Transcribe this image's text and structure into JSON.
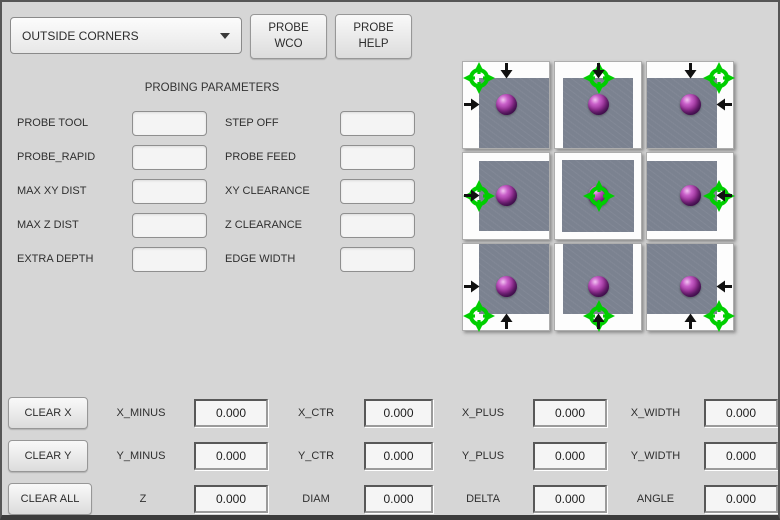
{
  "window": {
    "background": "#d6d6d6",
    "border_color": "#565656"
  },
  "toolbar": {
    "mode_select": {
      "value": "OUTSIDE CORNERS"
    },
    "probe_wco": {
      "line1": "PROBE",
      "line2": "WCO"
    },
    "probe_help": {
      "line1": "PROBE",
      "line2": "HELP"
    }
  },
  "parameters": {
    "title": "PROBING PARAMETERS",
    "fields": [
      {
        "label": "PROBE TOOL",
        "value": "",
        "placeholder": ""
      },
      {
        "label": "STEP OFF",
        "value": "",
        "placeholder": ""
      },
      {
        "label": "PROBE_RAPID",
        "value": "",
        "placeholder": ""
      },
      {
        "label": "PROBE FEED",
        "value": "",
        "placeholder": ""
      },
      {
        "label": "MAX XY DIST",
        "value": "",
        "placeholder": ""
      },
      {
        "label": "XY CLEARANCE",
        "value": "",
        "placeholder": ""
      },
      {
        "label": "MAX Z DIST",
        "value": "",
        "placeholder": ""
      },
      {
        "label": "Z CLEARANCE",
        "value": "",
        "placeholder": ""
      },
      {
        "label": "EXTRA DEPTH",
        "value": "",
        "placeholder": ""
      },
      {
        "label": "EDGE WIDTH",
        "value": "",
        "placeholder": ""
      }
    ]
  },
  "probe_grid": {
    "colors": {
      "target_green": "#00ce00",
      "sphere_purple": "#932f93",
      "surface_gray": "#7b8290",
      "arrow_black": "#111111",
      "cell_white": "#fdfdfd"
    },
    "cells": [
      {
        "position": "top-left",
        "arrows": [
          "down",
          "right"
        ]
      },
      {
        "position": "top-center",
        "arrows": [
          "down"
        ]
      },
      {
        "position": "top-right",
        "arrows": [
          "down",
          "left"
        ]
      },
      {
        "position": "middle-left",
        "arrows": [
          "right"
        ]
      },
      {
        "position": "center",
        "arrows": []
      },
      {
        "position": "middle-right",
        "arrows": [
          "left"
        ]
      },
      {
        "position": "bottom-left",
        "arrows": [
          "right",
          "up"
        ]
      },
      {
        "position": "bottom-center",
        "arrows": [
          "up"
        ]
      },
      {
        "position": "bottom-right",
        "arrows": [
          "left",
          "up"
        ]
      }
    ]
  },
  "results": {
    "rows": [
      {
        "button": "CLEAR X",
        "fields": [
          {
            "label": "X_MINUS",
            "value": "0.000"
          },
          {
            "label": "X_CTR",
            "value": "0.000"
          },
          {
            "label": "X_PLUS",
            "value": "0.000"
          },
          {
            "label": "X_WIDTH",
            "value": "0.000"
          }
        ]
      },
      {
        "button": "CLEAR Y",
        "fields": [
          {
            "label": "Y_MINUS",
            "value": "0.000"
          },
          {
            "label": "Y_CTR",
            "value": "0.000"
          },
          {
            "label": "Y_PLUS",
            "value": "0.000"
          },
          {
            "label": "Y_WIDTH",
            "value": "0.000"
          }
        ]
      },
      {
        "button": "CLEAR ALL",
        "fields": [
          {
            "label": "Z",
            "value": "0.000"
          },
          {
            "label": "DIAM",
            "value": "0.000"
          },
          {
            "label": "DELTA",
            "value": "0.000"
          },
          {
            "label": "ANGLE",
            "value": "0.000"
          }
        ]
      }
    ]
  }
}
